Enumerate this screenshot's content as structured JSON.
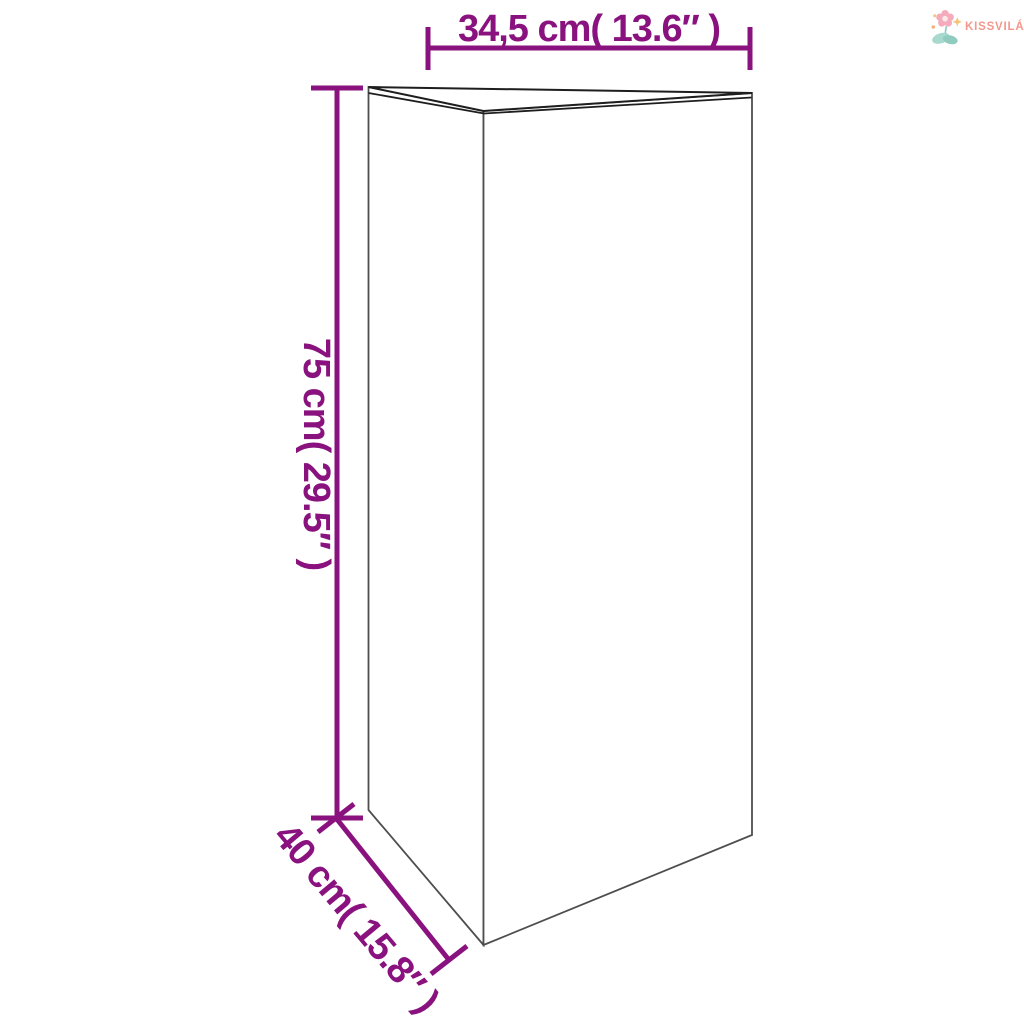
{
  "brand": {
    "name": "KISSVILÁG",
    "text_color": "#F2988C",
    "icon": {
      "name": "flower-logo-icon",
      "petal_color": "#F4ACBC",
      "petal_center_color": "#FBE9E7",
      "leaf_color": "#A7D9CE",
      "leaf_dark_color": "#8FCBBF",
      "sparkle_color": "#F6C474",
      "dot_color": "#F5B07E"
    }
  },
  "diagram": {
    "kind": "product-dimension-line-drawing",
    "subject": "triangular prism planter, open top, front edge facing viewer",
    "accent_color": "#8A127F",
    "outline_color": "#4E4E4E",
    "rim_color": "#1E1E1E",
    "dimensions": {
      "width": {
        "label": "34,5 cm( 13.6″ )",
        "cm": "34,5",
        "inches": "13.6",
        "orientation": "horizontal-top"
      },
      "height": {
        "label": "75 cm( 29.5″ )",
        "cm": "75",
        "inches": "29.5",
        "orientation": "vertical-left-rotated-90"
      },
      "depth": {
        "label": "40 cm( 15.8″ )",
        "cm": "40",
        "inches": "15.8",
        "orientation": "diagonal-bottom-left-rotated-50"
      }
    }
  }
}
